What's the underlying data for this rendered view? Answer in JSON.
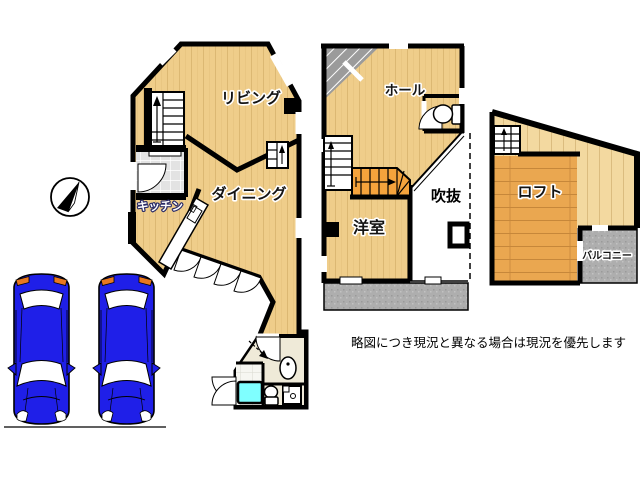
{
  "floorplan": {
    "floor1": {
      "living": "リビング",
      "dining": "ダイニング",
      "kitchen": "キッチン"
    },
    "floor2": {
      "hall": "ホール",
      "western_room": "洋室",
      "atrium": "吹抜"
    },
    "loft_floor": {
      "loft": "ロフト",
      "balcony": "バルコニー"
    },
    "note": "略図につき現況と異なる場合は現況を優先します",
    "colors": {
      "wood_floor": "#EFCD8A",
      "wood_plank_line": "#DCB873",
      "loft_wood_dark": "#EAA750",
      "loft_wood_light": "#F3D9A0",
      "wall": "#000000",
      "balcony_gray": "#AEAEAE",
      "entrance_tile": "#E3E3E3",
      "bath_tile": "#F6F6F1",
      "hall_cream": "#EFEAD8",
      "bathtub_cyan": "#7FFFFF",
      "stair_orange": "#F5A33C",
      "car_blue": "#1F1FE8",
      "car_taillight_orange": "#E87820"
    },
    "icons": [
      "compass-north-icon",
      "car-top-view-icon",
      "stairs-up-arrow-icon",
      "bathtub-icon",
      "toilet-icon",
      "washbasin-icon",
      "door-swing-icon"
    ]
  }
}
